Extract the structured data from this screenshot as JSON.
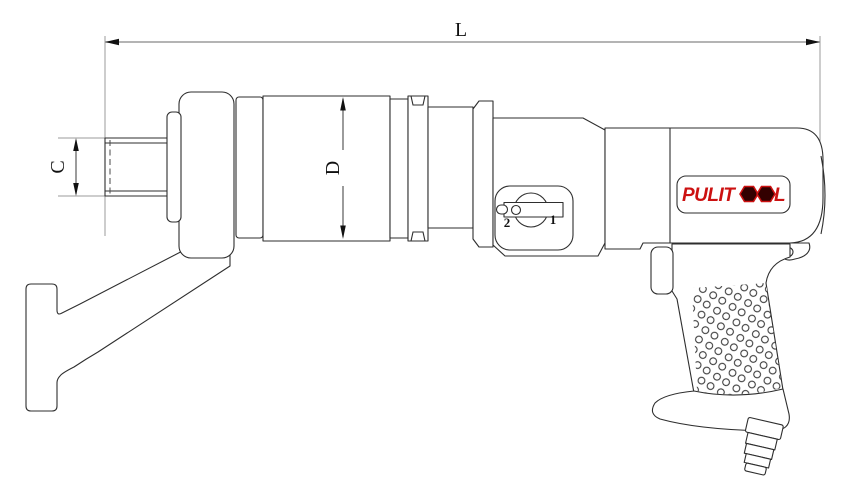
{
  "drawing": {
    "type": "technical line drawing",
    "subject": "pneumatic torque wrench side view with dimension callouts",
    "dimension_labels": {
      "overall_length": "L",
      "square_drive": "C",
      "body_diameter": "D"
    },
    "selector_dial": {
      "position_forward": "1",
      "position_reverse": "2"
    },
    "brand_label": {
      "full": "PULITOOL",
      "prefix": "PULIT",
      "suffix": "L"
    },
    "colors": {
      "outline": "#2e2e2e",
      "dimension_line": "#9b9b9b",
      "dimension_mark": "#4a4a4a",
      "arrow": "#111111",
      "logo_red": "#cc1111",
      "logo_hex_fill": "#330000",
      "background": "#ffffff"
    }
  }
}
